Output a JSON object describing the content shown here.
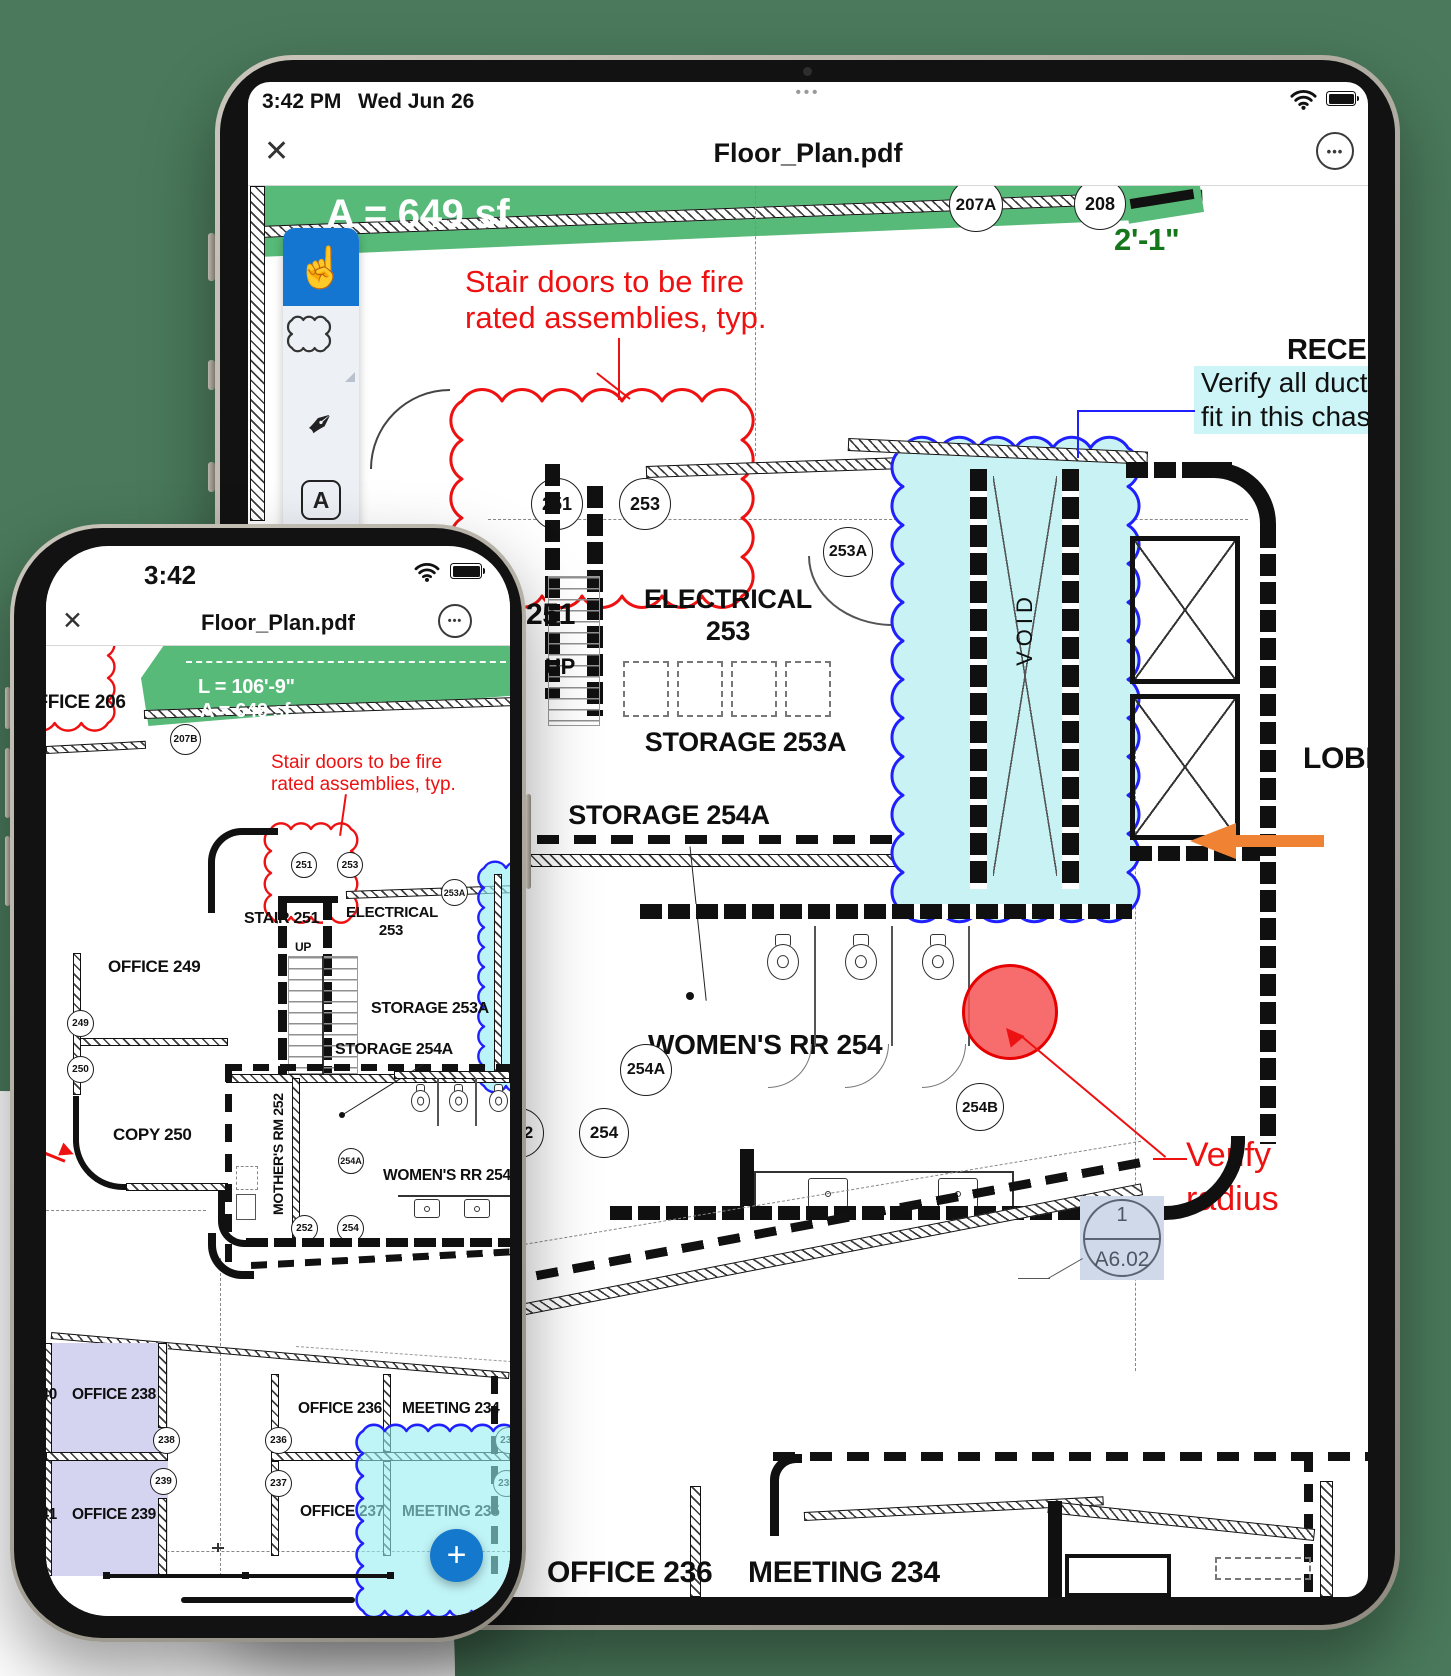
{
  "background": {
    "canvas_green": "#4a795b",
    "corner_white": "#ffffff"
  },
  "colors": {
    "plan_green": "#57ba78",
    "dark_green": "#15761c",
    "annotation_red": "#ee1111",
    "cloud_blue": "#2020ff",
    "cyan_fill": "#c9f2f4",
    "purple_room": "#d4d3f0",
    "orange_arrow": "#f08233",
    "tool_blue": "#1576d2",
    "fab_blue": "#1478cc",
    "callout_bg": "#cfd9e9"
  },
  "ipad": {
    "status": {
      "time": "3:42 PM",
      "date": "Wed Jun 26",
      "handle_dots": "•••"
    },
    "nav": {
      "title": "Floor_Plan.pdf",
      "close_glyph": "✕",
      "more_glyph": "•••"
    },
    "toolbar": {
      "hand_glyph": "☝",
      "pen_glyph": "✒",
      "text_tool": "A"
    },
    "plan": {
      "banner_area": "A = 649 sf",
      "dim": "2'-1\"",
      "note_fire_1": "Stair doors to be fire",
      "note_fire_2": "rated assemblies, typ.",
      "note_duct_1": "Verify all ducting w",
      "note_duct_2": "fit in this chase",
      "note_verify_1": "Verify",
      "note_verify_2": "radius",
      "reception": "RECEPTION",
      "lobby": "LOBBY",
      "void": "VOID",
      "up": "UP",
      "room_251": "251",
      "electrical": "ELECTRICAL",
      "electrical_num": "253",
      "storage_253a": "STORAGE 253A",
      "storage_254a": "STORAGE 254A",
      "womens_rr": "WOMEN'S RR  254",
      "office_236": "OFFICE 236",
      "meeting_234": "MEETING  234",
      "callout_top": "1",
      "callout_bottom": "A6.02",
      "tags": {
        "t207a": "207A",
        "t208": "208",
        "t251": "251",
        "t253": "253",
        "t253a": "253A",
        "t254a": "254A",
        "t254b": "254B",
        "t252": "252",
        "t254": "254"
      }
    }
  },
  "iphone": {
    "status": {
      "time": "3:42"
    },
    "nav": {
      "title": "Floor_Plan.pdf",
      "close_glyph": "✕",
      "more_glyph": "•••"
    },
    "fab_glyph": "+",
    "plan": {
      "office_206": "OFFICE  206",
      "banner_len": "L = 106'-9\"",
      "banner_area": "A = 649 sf",
      "note_fire_1": "Stair doors to be fire",
      "note_fire_2": "rated assemblies, typ.",
      "stair_251": "STAIR 251",
      "up": "UP",
      "electrical": "ELECTRICAL",
      "electrical_num": "253",
      "office_249": "OFFICE  249",
      "storage_253a": "STORAGE 253A",
      "storage_254a": "STORAGE 254A",
      "copy_250": "COPY  250",
      "mothers_rm": "MOTHER'S RM 252",
      "womens_rr": "WOMEN'S RR  254",
      "office_240": "240",
      "office_241": "241",
      "office_238": "OFFICE  238",
      "office_239": "OFFICE  239",
      "office_236": "OFFICE 236",
      "office_237": "OFFICE 237",
      "meeting_234": "MEETING  234",
      "meeting_235": "MEETING  235",
      "tags": {
        "t207b": "207B",
        "t251": "251",
        "t253": "253",
        "t253a": "253A",
        "t249": "249",
        "t250": "250",
        "t254a": "254A",
        "t252": "252",
        "t254": "254",
        "t238": "238",
        "t239": "239",
        "t236": "236",
        "t237": "237",
        "t234": "234",
        "t235": "235"
      }
    }
  }
}
